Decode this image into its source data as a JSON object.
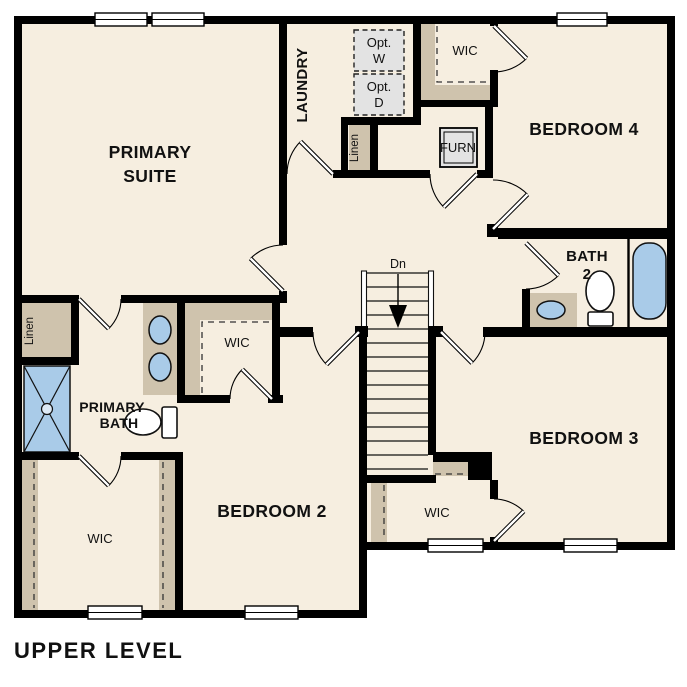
{
  "plan": {
    "title": "UPPER LEVEL",
    "level": "UPPER LEVEL"
  },
  "labels": {
    "primary_suite_1": "PRIMARY",
    "primary_suite_2": "SUITE",
    "laundry": "LAUNDRY",
    "opt_w_1": "Opt.",
    "opt_w_2": "W",
    "opt_d_1": "Opt.",
    "opt_d_2": "D",
    "wic_bedroom4": "WIC",
    "bedroom4": "BEDROOM 4",
    "furnace": "FURN",
    "linen_hall": "Linen",
    "bath2_1": "BATH",
    "bath2_2": "2",
    "stairs_dn": "Dn",
    "linen_primary": "Linen",
    "wic_primary": "WIC",
    "primary_bath_1": "PRIMARY",
    "primary_bath_2": "BATH",
    "bedroom2": "BEDROOM 2",
    "wic_bedroom2": "WIC",
    "wic_bedroom3": "WIC",
    "bedroom3": "BEDROOM 3"
  },
  "icons": {
    "shower": "shower-pan-with-drain",
    "tub": "bathtub",
    "toilet_bath2": "toilet",
    "toilet_primary": "toilet",
    "sink_double_vanity": "two-oval-sinks",
    "sink_bath2": "oval-sink",
    "washer": "optional-washer-box",
    "dryer": "optional-dryer-box",
    "furnace": "furnace-unit",
    "stairs": "staircase-down-arrow"
  },
  "colors": {
    "floor": "#f6eee0",
    "closet_tan": "#cfc3ad",
    "fixture_blue": "#a9cbe8",
    "appliance_gray": "#e3e3e3",
    "wall": "#000000"
  }
}
